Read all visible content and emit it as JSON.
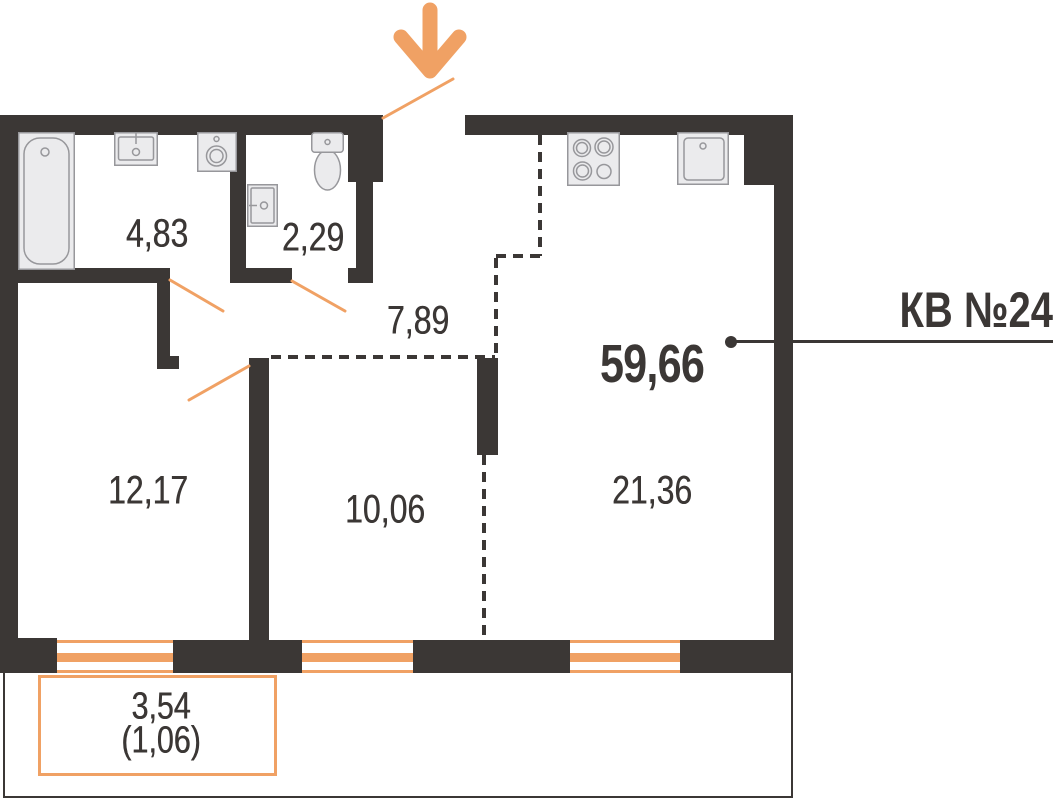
{
  "apartment": {
    "label": "КВ №24",
    "total_area": "59,66"
  },
  "rooms": {
    "bathroom": {
      "area": "4,83"
    },
    "wc": {
      "area": "2,29"
    },
    "hallway": {
      "area": "7,89"
    },
    "bedroom": {
      "area": "12,17"
    },
    "room": {
      "area": "10,06"
    },
    "living_kitchen": {
      "area": "21,36"
    },
    "balcony": {
      "area": "3,54",
      "area_coefficient": "(1,06)"
    }
  },
  "colors": {
    "wall": "#3B3735",
    "accent": "#F0A164",
    "fixture_fill": "#EBEBED",
    "fixture_stroke": "#97979B",
    "text": "#3B3735"
  },
  "icons": {
    "entrance": "entrance-arrow-icon",
    "fixtures": [
      "bathtub-icon",
      "bathroom-sink-icon",
      "washing-machine-icon",
      "wc-sink-icon",
      "toilet-icon",
      "stove-icon",
      "kitchen-sink-icon"
    ]
  }
}
